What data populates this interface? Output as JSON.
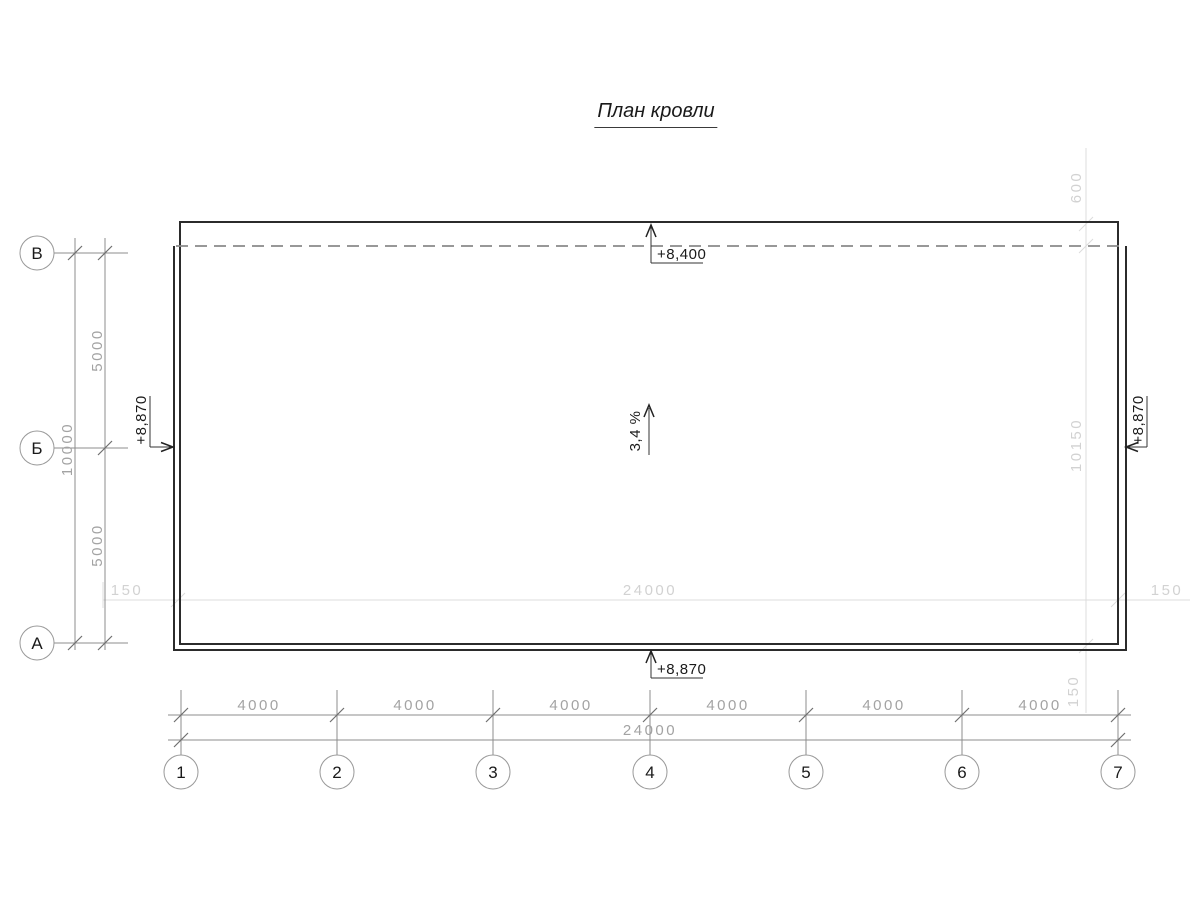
{
  "title": "План кровли",
  "colors": {
    "outline_dark": "#2b2b2b",
    "grid_gray": "#8c8c8c",
    "overlay_light": "#dcdcdc",
    "text_dark": "#1a1a1a",
    "text_gray": "#a3a3a3",
    "text_light": "#d2d2d2"
  },
  "row_axes": {
    "labels": [
      "1",
      "2",
      "3",
      "4",
      "5",
      "6",
      "7"
    ]
  },
  "col_axes": {
    "labels": [
      "В",
      "Б",
      "А"
    ]
  },
  "dims": {
    "bays": [
      "4000",
      "4000",
      "4000",
      "4000",
      "4000",
      "4000"
    ],
    "total_width": "24000",
    "left_segments": [
      "5000",
      "5000"
    ],
    "left_total": "10000"
  },
  "overlay_dims": {
    "top_offset": "600",
    "right_height": "10150",
    "wall_left": "150",
    "wall_total": "24000",
    "wall_right": "150",
    "parapet": "150"
  },
  "elevations": {
    "top": "+8,400",
    "bottom": "+8,870",
    "left": "+8,870",
    "right": "+8,870"
  },
  "slope_label": "3,4 %"
}
